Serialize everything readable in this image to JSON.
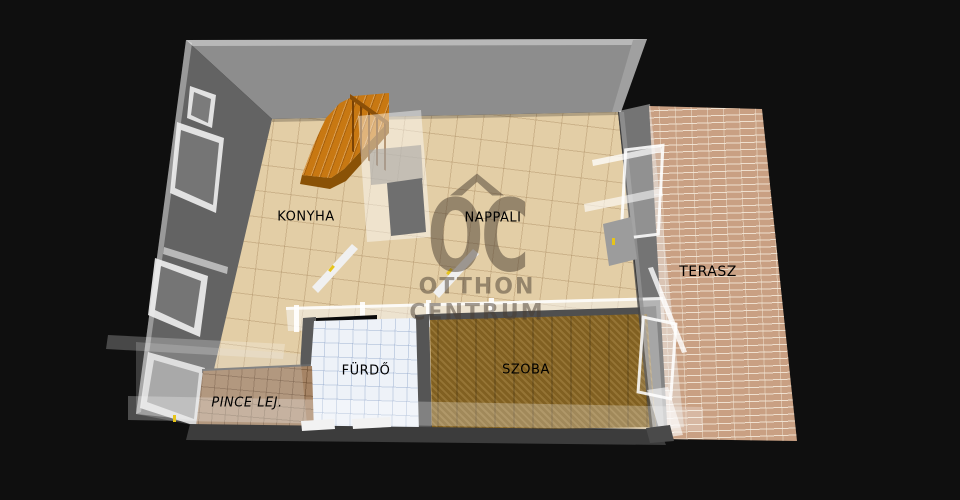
{
  "scene": {
    "type": "3d-floorplan-render",
    "description": "Isometric 3D floor plan of an apartment level on black background"
  },
  "labels": {
    "konyha": "KONYHA",
    "nappali": "NAPPALI",
    "terasz": "TERASZ",
    "furdo": "FÜRDŐ",
    "szoba": "SZOBA",
    "pince": "PINCE LEJ."
  },
  "watermark": {
    "initials": "OC",
    "line1": "OTTHON",
    "line2": "CENTRUM"
  },
  "palette": {
    "background": "#0f0f0f",
    "top_wall_gray": "#8d8d8d",
    "left_wall_gray": "#636363",
    "floor_tile_tan": "#e3cea6",
    "bathroom_tile": "#eef2f8",
    "room_wood_brown": "#8d6a26",
    "cellar_tile_brown": "#a68465",
    "terrace_brick": "#c9a083",
    "stairs_orange": "#c87812",
    "door_handle_yellow": "#e6c41a",
    "label_text": "#000000",
    "watermark_color": "rgba(72,60,48,0.5)"
  }
}
